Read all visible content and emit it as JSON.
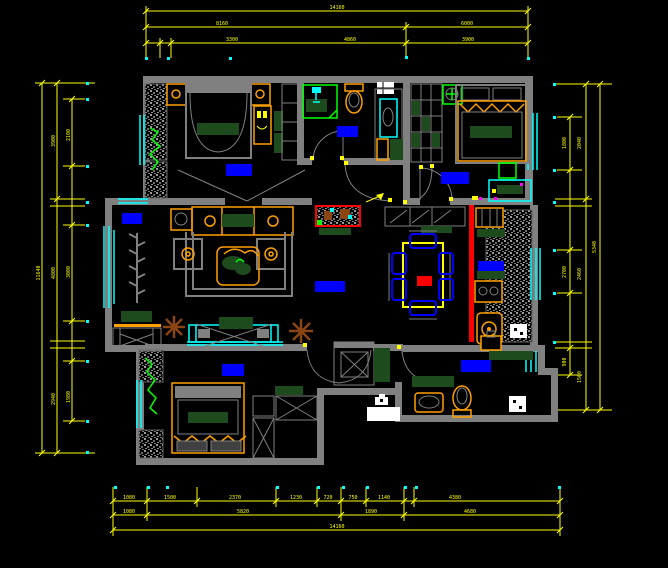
{
  "canvas": {
    "type": "cad-floor-plan",
    "background": "#000000"
  },
  "colors": {
    "walls": "#808080",
    "dimensions": "#ffff00",
    "windows": "#00ffff",
    "furniture_accent": "#ffa000",
    "fixture_green": "#00ff00",
    "upholstery_green": "#1d4b1d",
    "room_label_block": "#0000ff",
    "highlight_wall": "#ff0000",
    "plant": "#8b4513"
  },
  "dims": {
    "top": [
      "14160",
      "8160",
      "6000",
      "3300",
      "4860",
      "3900"
    ],
    "bottom": [
      "1080",
      "1500",
      "2370",
      "1230",
      "720",
      "750",
      "1140",
      "4380",
      "1080",
      "5820",
      "1890",
      "4680",
      "14160"
    ],
    "left": [
      "11640",
      "3900",
      "4800",
      "2940",
      "2100",
      "3000",
      "1980"
    ],
    "right": [
      "1800",
      "2700",
      "900",
      "2040",
      "2460",
      "1500",
      "5340"
    ]
  }
}
